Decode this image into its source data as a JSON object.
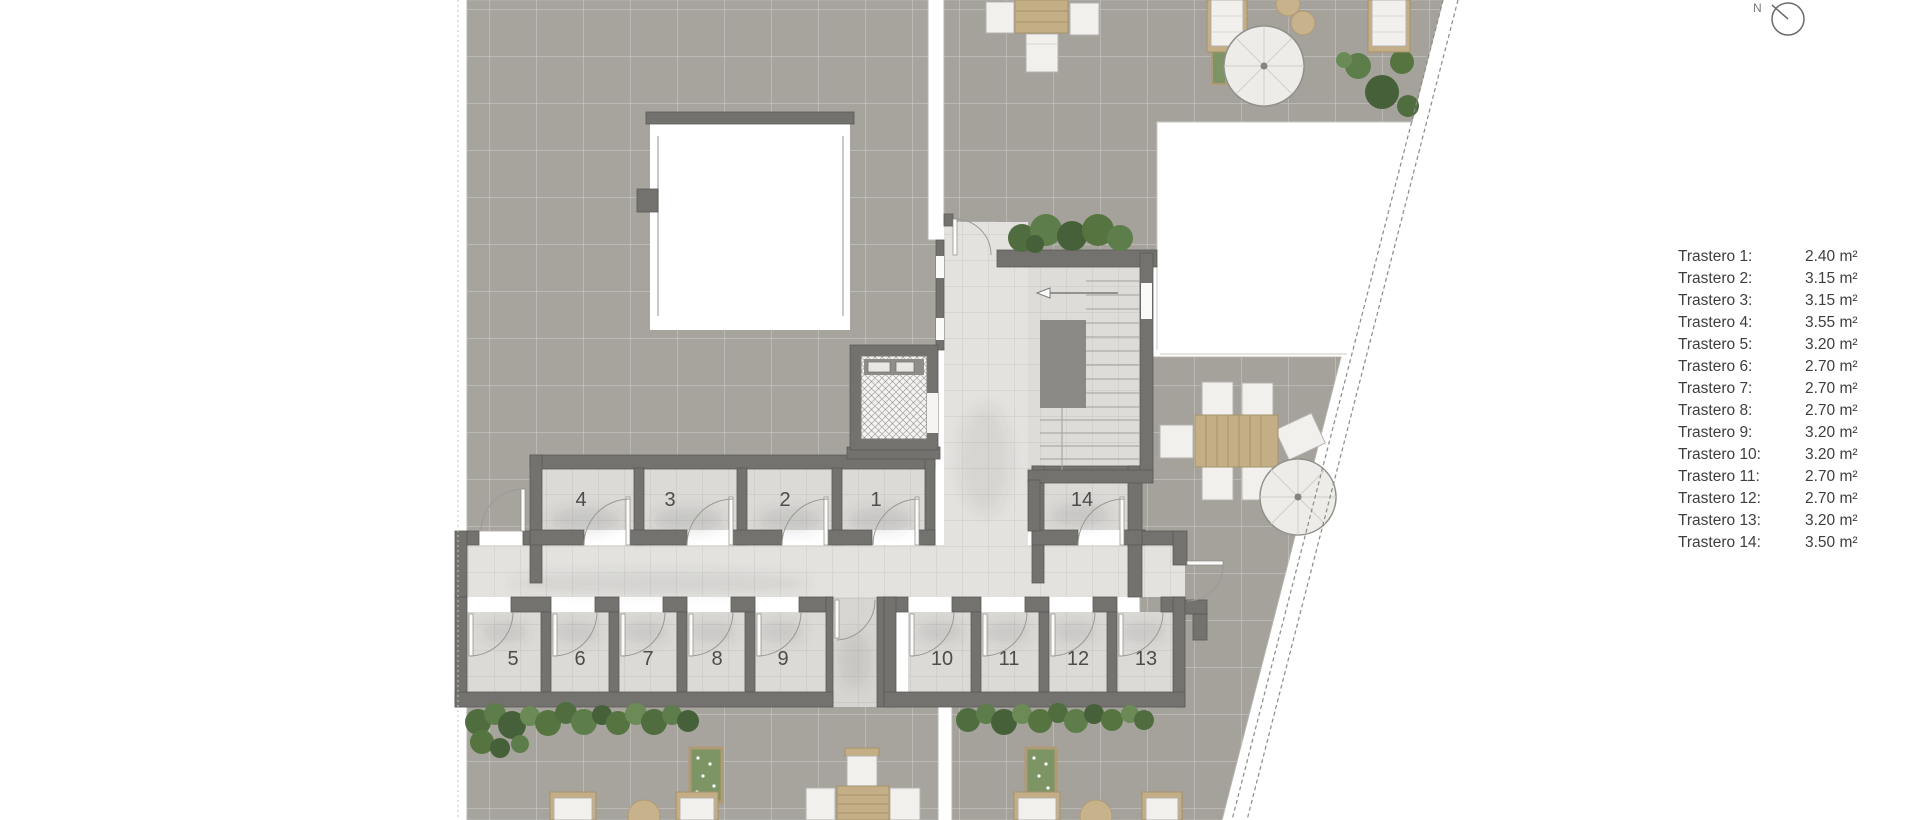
{
  "legend": {
    "items": [
      {
        "label": "Trastero 1:",
        "area": "2.40 m²"
      },
      {
        "label": "Trastero 2:",
        "area": "3.15 m²"
      },
      {
        "label": "Trastero 3:",
        "area": "3.15 m²"
      },
      {
        "label": "Trastero 4:",
        "area": "3.55 m²"
      },
      {
        "label": "Trastero 5:",
        "area": "3.20 m²"
      },
      {
        "label": "Trastero 6:",
        "area": "2.70 m²"
      },
      {
        "label": "Trastero 7:",
        "area": "2.70 m²"
      },
      {
        "label": "Trastero 8:",
        "area": "2.70 m²"
      },
      {
        "label": "Trastero 9:",
        "area": "3.20 m²"
      },
      {
        "label": "Trastero 10:",
        "area": "3.20 m²"
      },
      {
        "label": "Trastero 11:",
        "area": "2.70 m²"
      },
      {
        "label": "Trastero 12:",
        "area": "2.70 m²"
      },
      {
        "label": "Trastero 13:",
        "area": "3.20 m²"
      },
      {
        "label": "Trastero 14:",
        "area": "3.50 m²"
      }
    ]
  },
  "plan": {
    "rooms": [
      {
        "number": "1"
      },
      {
        "number": "2"
      },
      {
        "number": "3"
      },
      {
        "number": "4"
      },
      {
        "number": "5"
      },
      {
        "number": "6"
      },
      {
        "number": "7"
      },
      {
        "number": "8"
      },
      {
        "number": "9"
      },
      {
        "number": "10"
      },
      {
        "number": "11"
      },
      {
        "number": "12"
      },
      {
        "number": "13"
      },
      {
        "number": "14"
      }
    ]
  },
  "north": {
    "label": "N"
  },
  "colors": {
    "wall": "#73726e",
    "terrace": "#a7a49e",
    "room_floor": "#dbdad7",
    "corridor_floor": "#e3e2df",
    "greenery": "#55743f",
    "wood": "#c3ae86",
    "white_furniture": "#f1f0ed",
    "legend_text": "#3e3e3c"
  }
}
